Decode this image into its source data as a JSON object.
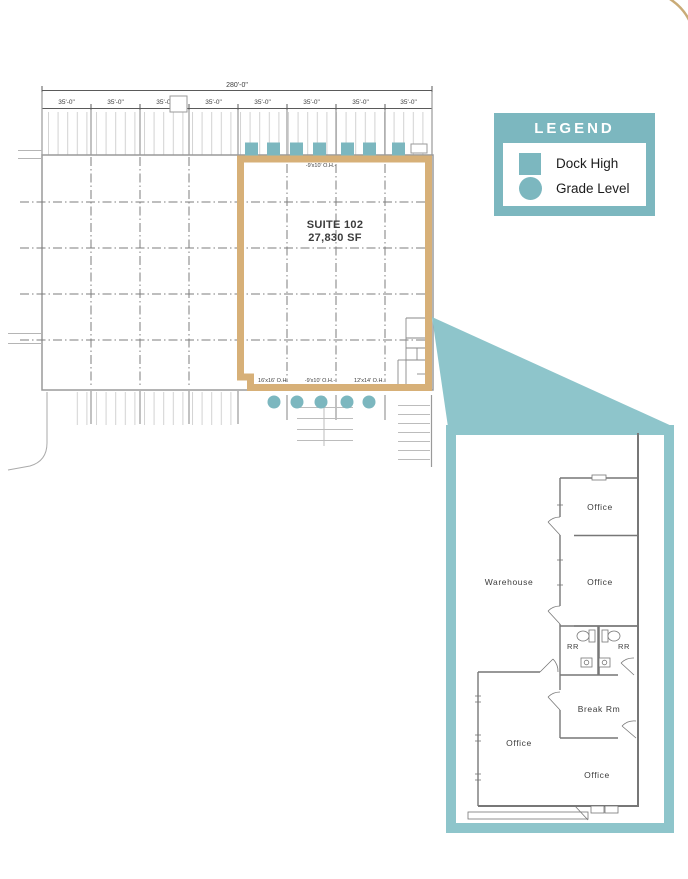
{
  "site_plan": {
    "overall_dim": "280'-0\"",
    "bay_dim": "35'-0\"",
    "suite_name": "SUITE 102",
    "suite_area": "27,830 SF",
    "top_door_label": "-9'x10' O.H.-",
    "bottom_door_labels": [
      "16'x16' O.H.",
      "-9'x10' O.H.-",
      "12'x14' O.H."
    ]
  },
  "legend": {
    "title": "LEGEND",
    "items": [
      {
        "label": "Dock High",
        "marker": "square"
      },
      {
        "label": "Grade Level",
        "marker": "circle"
      }
    ]
  },
  "detail_plan": {
    "warehouse": "Warehouse",
    "office": "Office",
    "rr": "RR",
    "break_room": "Break Rm"
  },
  "colors": {
    "teal": "#7cb7bf",
    "teal_light": "#8ec5cb",
    "tan": "#d7b078",
    "corner_arc": "#c9ab77"
  }
}
